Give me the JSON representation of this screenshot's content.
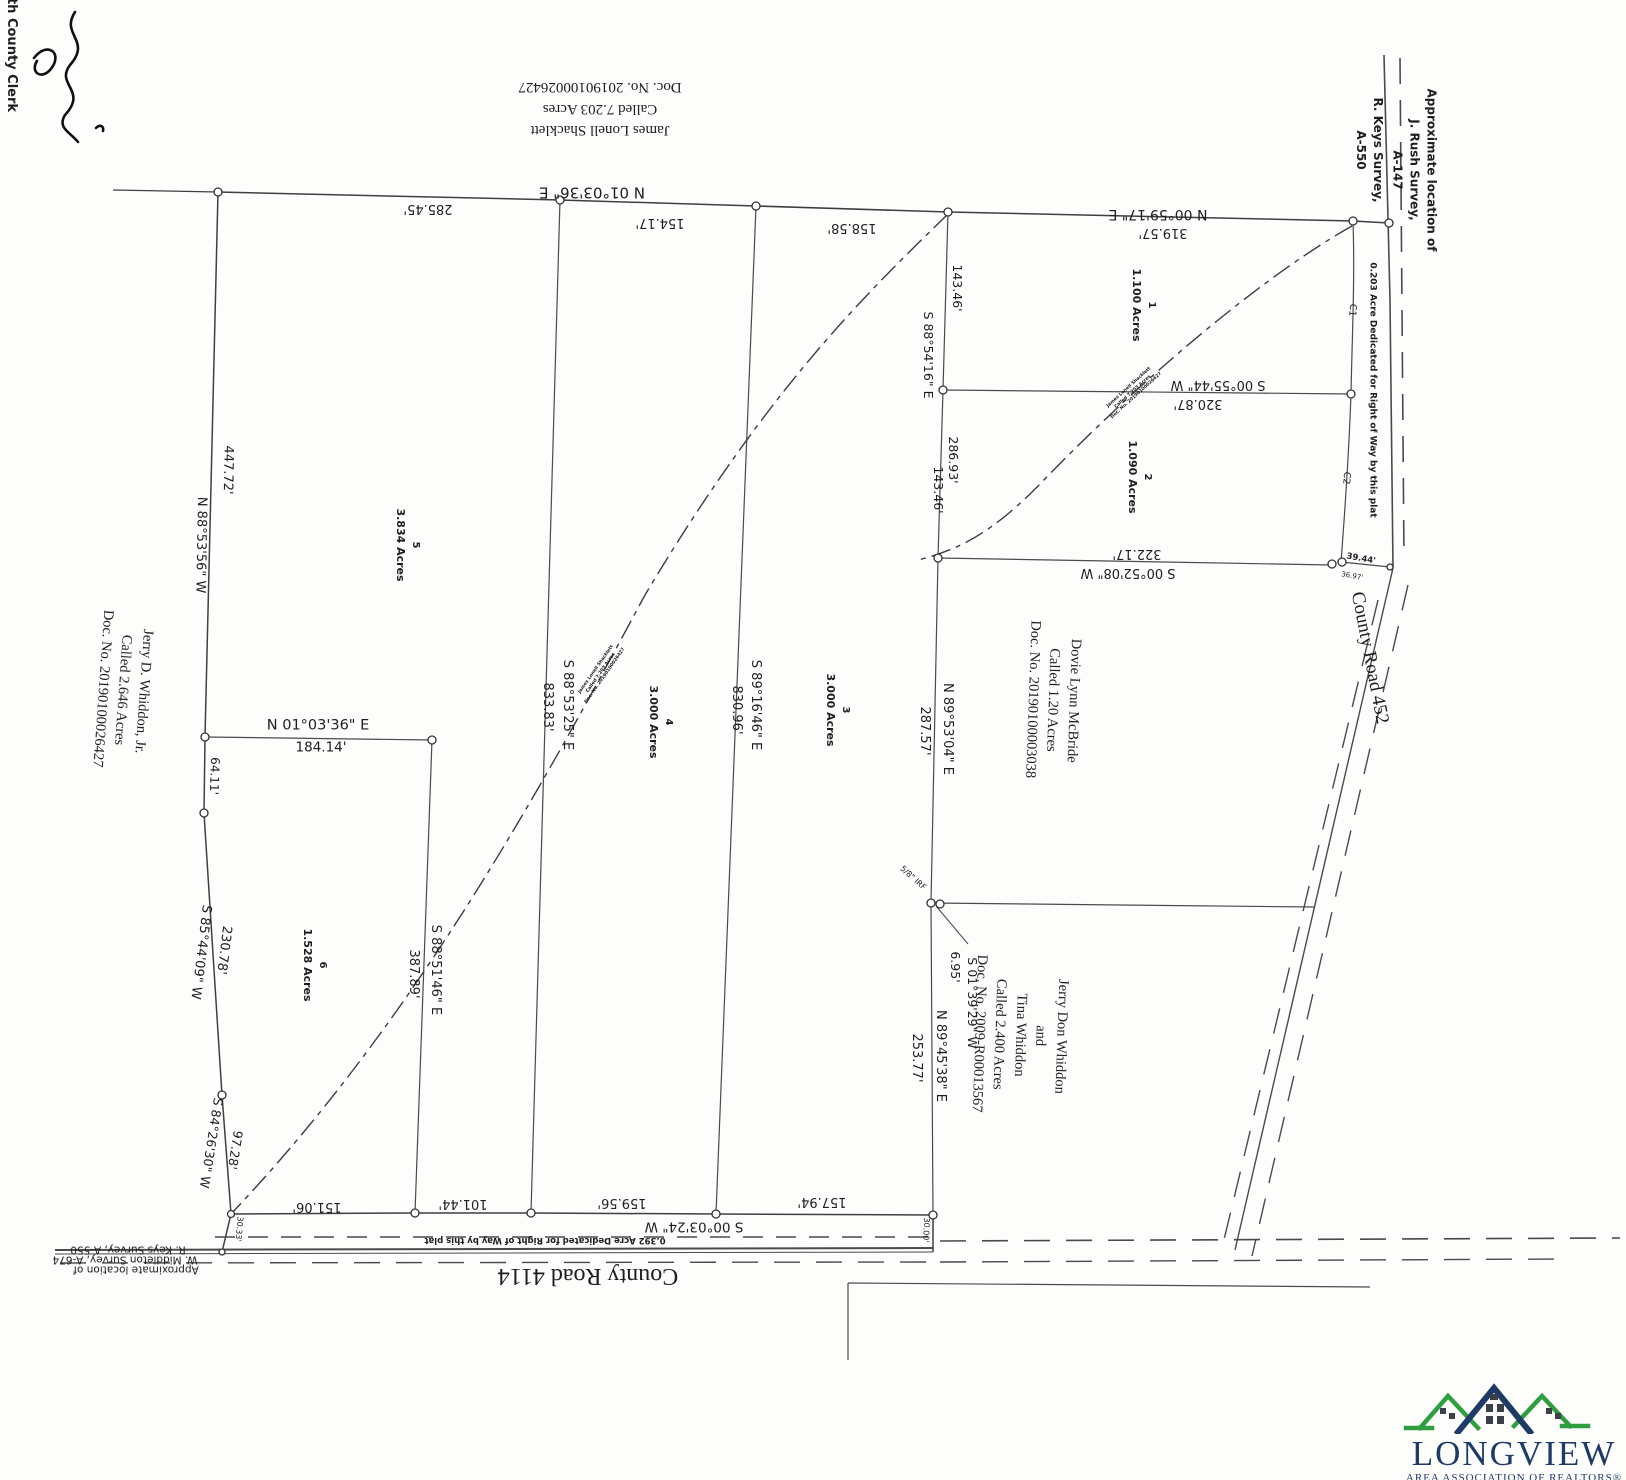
{
  "clerk": {
    "label": "th County Clerk"
  },
  "tracts": {
    "north": {
      "lines": [
        "James Lonell Shacklett",
        "Called 7.203 Acres",
        "Doc. No. 20190100026427"
      ]
    },
    "west": {
      "lines": [
        "Jerry D. Whiddon, Jr.",
        "Called 2.646 Acres",
        "Doc. No. 20190100026427"
      ]
    },
    "east": {
      "lines": [
        "Dovie Lynn McBride",
        "Called 1.20 Acres",
        "Doc. No. 20190100003038"
      ]
    },
    "southeast": {
      "lines": [
        "Jerry Don Whiddon",
        "and",
        "Tina Whiddon",
        "Called 2.400 Acres",
        "Doc. No. 2009-R00013567"
      ]
    }
  },
  "lots": [
    {
      "number": "1",
      "acres": "1.100 Acres"
    },
    {
      "number": "2",
      "acres": "1.090 Acres"
    },
    {
      "number": "3",
      "acres": "3.000 Acres"
    },
    {
      "number": "4",
      "acres": "3.000 Acres"
    },
    {
      "number": "5",
      "acres": "3.834 Acres"
    },
    {
      "number": "6",
      "acres": "1.528 Acres"
    }
  ],
  "dims": {
    "bearing_n010336": "N 01°03'36\" E",
    "d285": "285.45'",
    "d154": "154.17'",
    "d158": "158.58'",
    "bearing_n005917": "N 00°59'17\" E",
    "d319": "319.57'",
    "d143a": "143.46'",
    "bearing_s885416": "S 88°54'16\" E",
    "d286": "286.93'",
    "d143b": "143.46'",
    "bearing_s005544": "S 00°55'44\" W",
    "d320": "320.87'",
    "d322": "322.17'",
    "bearing_s005208": "S 00°52'08\" W",
    "d3944": "39.44'",
    "d3697": "36.97'",
    "bearing_n895304": "N 89°53'04\" E",
    "d287": "287.57'",
    "bearing_s891646": "S 89°16'46\" E",
    "d830": "830.96'",
    "bearing_s885325": "S 88°53'25\" E",
    "d833": "833.83'",
    "d447": "447.72'",
    "bearing_n885356": "N 88°53'56\" W",
    "d64": "64.11'",
    "d230": "230.78'",
    "bearing_s854409": "S 85°44'09\" W",
    "d97": "97.28'",
    "bearing_s842630": "S 84°26'30\" W",
    "d184": "184.14'",
    "bearing_s885146": "S 88°51'46\" E",
    "d387": "387.89'",
    "irf": "5/8\" IRF",
    "bearing_s013929": "S 01°39'29\" W",
    "d695": "6.95'",
    "bearing_n894538": "N 89°45'38\" E",
    "d253": "253.77'",
    "d157": "157.94'",
    "d159": "159.56'",
    "d101": "101.44'",
    "d151": "151.06'",
    "bearing_s000324": "S 00°03'24\" W",
    "d3033": "30.33'",
    "d3000": "30.00'"
  },
  "roads": {
    "east": "County Road 452",
    "south": "County Road 4114"
  },
  "row_dedications": {
    "east": "0.203 Acre Dedicated for Right of Way by this plat",
    "south": "0.392 Acre Dedicated for Right of Way by this plat"
  },
  "curves": {
    "c1": "C1",
    "c2": "C2"
  },
  "survey_notes": {
    "northeast1": {
      "lines": [
        "Approximate location of",
        "J. Rush Survey,",
        "A-147"
      ]
    },
    "northeast2": {
      "lines": [
        "R. Keys Survey,",
        "A-550"
      ]
    },
    "southwest": {
      "lines": [
        "Approximate location of",
        "W. Middleton Survey, A-674",
        "R. Keys Survey, A-550"
      ]
    }
  },
  "tiny_note": {
    "lines": [
      "James Lonell Shacklett",
      "Called 7.203 Acres",
      "Doc. No. 20190100026427"
    ]
  },
  "logo": {
    "title": "LONGVIEW",
    "subtitle": "AREA ASSOCIATION OF REALTORS®",
    "navy": "#1e3a66",
    "green": "#2f9e41"
  }
}
